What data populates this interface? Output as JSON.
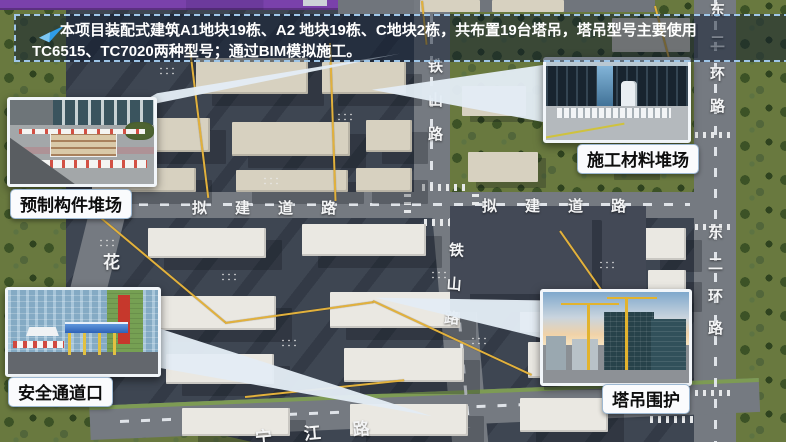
{
  "banner": {
    "icon": "send-arrow-icon",
    "line1": "本项目装配式建筑A1地块19栋、A2 地块19栋、C地块2栋，共布置19台塔吊，塔吊型号主要使用",
    "line2": "TC6515、TC7020两种型号；通过BIM模拟施工。"
  },
  "callouts": [
    {
      "id": "precast-yard",
      "label": "预制构件堆场"
    },
    {
      "id": "material-yard",
      "label": "施工材料堆场"
    },
    {
      "id": "safety-passage",
      "label": "安全通道口"
    },
    {
      "id": "crane-enclosure",
      "label": "塔吊围护"
    }
  ],
  "roads": {
    "tieshan": "铁山路",
    "proposed": "拟建道路",
    "east_second_ring": "东二环路",
    "hua": "花",
    "bottom": "宁江路"
  },
  "colors": {
    "accent_purple": "#7a41ab",
    "banner_border": "#9fc6e8",
    "crane_line_yellow": "#e2b13c",
    "site_ground": "#3e4652"
  }
}
